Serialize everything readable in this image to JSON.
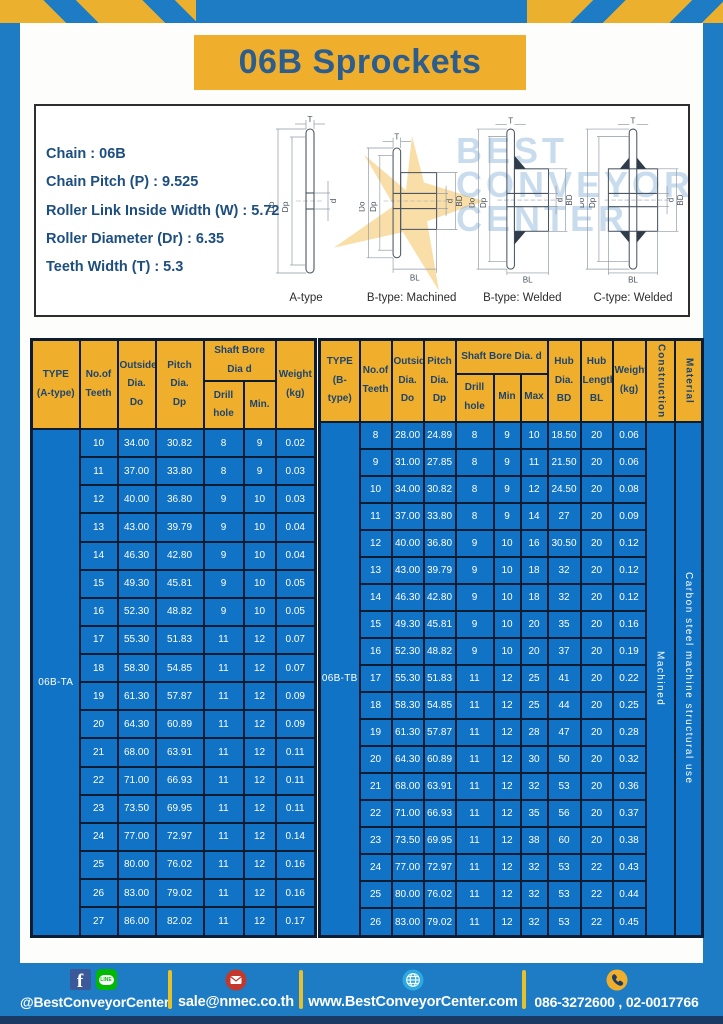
{
  "page": {
    "title": "06B Sprockets"
  },
  "theme": {
    "frame_blue": "#1d7cc4",
    "cell_blue": "#1173c6",
    "accent_yellow": "#efaf2c",
    "header_text_navy": "#1d4470",
    "title_text_blue": "#2d5d8c",
    "table_border": "#0c1c33",
    "bottom_strip_navy": "#1a3a63"
  },
  "specs": {
    "lines": [
      "Chain : 06B",
      "Chain Pitch (P) : 9.525",
      "Roller Link Inside Width (W) : 5.72",
      "Roller Diameter (Dr) : 6.35",
      "Teeth Width (T) : 5.3"
    ]
  },
  "watermark": {
    "lines": [
      "BEST",
      "CONVEYOR",
      "CENTER"
    ]
  },
  "diagrams": [
    {
      "caption": "A-type",
      "dims": {
        "T": "T",
        "Do": "Do",
        "Dp": "Dp",
        "d": "d"
      }
    },
    {
      "caption": "B-type: Machined",
      "dims": {
        "T": "T",
        "Do": "Do",
        "Dp": "Dp",
        "d": "d",
        "BD": "BD",
        "BL": "BL"
      }
    },
    {
      "caption": "B-type: Welded",
      "dims": {
        "T": "T",
        "Do": "Do",
        "Dp": "Dp",
        "d": "d",
        "BD": "BD",
        "BL": "BL"
      }
    },
    {
      "caption": "C-type: Welded",
      "dims": {
        "T": "T",
        "Do": "Do",
        "Dp": "Dp",
        "d": "d",
        "BD": "BD",
        "BL": "BL"
      }
    }
  ],
  "table_a": {
    "type_label": "06B-TA",
    "headers": {
      "type": "TYPE\n(A-type)",
      "teeth": "No.of\nTeeth",
      "outside": "Outside\nDia.\nDo",
      "pitch": "Pitch Dia.\nDp",
      "shaft_group": "Shaft Bore Dia d",
      "drill": "Drill hole",
      "min": "Min.",
      "weight": "Weight\n(kg)"
    },
    "rows": [
      [
        "10",
        "34.00",
        "30.82",
        "8",
        "9",
        "0.02"
      ],
      [
        "11",
        "37.00",
        "33.80",
        "8",
        "9",
        "0.03"
      ],
      [
        "12",
        "40.00",
        "36.80",
        "9",
        "10",
        "0.03"
      ],
      [
        "13",
        "43.00",
        "39.79",
        "9",
        "10",
        "0.04"
      ],
      [
        "14",
        "46.30",
        "42.80",
        "9",
        "10",
        "0.04"
      ],
      [
        "15",
        "49.30",
        "45.81",
        "9",
        "10",
        "0.05"
      ],
      [
        "16",
        "52.30",
        "48.82",
        "9",
        "10",
        "0.05"
      ],
      [
        "17",
        "55.30",
        "51.83",
        "11",
        "12",
        "0.07"
      ],
      [
        "18",
        "58.30",
        "54.85",
        "11",
        "12",
        "0.07"
      ],
      [
        "19",
        "61.30",
        "57.87",
        "11",
        "12",
        "0.09"
      ],
      [
        "20",
        "64.30",
        "60.89",
        "11",
        "12",
        "0.09"
      ],
      [
        "21",
        "68.00",
        "63.91",
        "11",
        "12",
        "0.11"
      ],
      [
        "22",
        "71.00",
        "66.93",
        "11",
        "12",
        "0.11"
      ],
      [
        "23",
        "73.50",
        "69.95",
        "11",
        "12",
        "0.11"
      ],
      [
        "24",
        "77.00",
        "72.97",
        "11",
        "12",
        "0.14"
      ],
      [
        "25",
        "80.00",
        "76.02",
        "11",
        "12",
        "0.16"
      ],
      [
        "26",
        "83.00",
        "79.02",
        "11",
        "12",
        "0.16"
      ],
      [
        "27",
        "86.00",
        "82.02",
        "11",
        "12",
        "0.17"
      ]
    ]
  },
  "table_b": {
    "type_label": "06B-TB",
    "construction": "Machined",
    "material": "Carbon steel machine structural use",
    "headers": {
      "type": "TYPE\n(B-type)",
      "teeth": "No.of\nTeeth",
      "outside": "Outside\nDia.\nDo",
      "pitch": "Pitch\nDia.\nDp",
      "shaft_group": "Shaft Bore Dia. d",
      "drill": "Drill hole",
      "min": "Min",
      "max": "Max",
      "hub_dia": "Hub\nDia.\nBD",
      "hub_len": "Hub\nLength\nBL",
      "weight": "Weight\n(kg)",
      "construction": "Construction",
      "material": "Material"
    },
    "rows": [
      [
        "8",
        "28.00",
        "24.89",
        "8",
        "9",
        "10",
        "18.50",
        "20",
        "0.06"
      ],
      [
        "9",
        "31.00",
        "27.85",
        "8",
        "9",
        "11",
        "21.50",
        "20",
        "0.06"
      ],
      [
        "10",
        "34.00",
        "30.82",
        "8",
        "9",
        "12",
        "24.50",
        "20",
        "0.08"
      ],
      [
        "11",
        "37.00",
        "33.80",
        "8",
        "9",
        "14",
        "27",
        "20",
        "0.09"
      ],
      [
        "12",
        "40.00",
        "36.80",
        "9",
        "10",
        "16",
        "30.50",
        "20",
        "0.12"
      ],
      [
        "13",
        "43.00",
        "39.79",
        "9",
        "10",
        "18",
        "32",
        "20",
        "0.12"
      ],
      [
        "14",
        "46.30",
        "42.80",
        "9",
        "10",
        "18",
        "32",
        "20",
        "0.12"
      ],
      [
        "15",
        "49.30",
        "45.81",
        "9",
        "10",
        "20",
        "35",
        "20",
        "0.16"
      ],
      [
        "16",
        "52.30",
        "48.82",
        "9",
        "10",
        "20",
        "37",
        "20",
        "0.19"
      ],
      [
        "17",
        "55.30",
        "51.83",
        "11",
        "12",
        "25",
        "41",
        "20",
        "0.22"
      ],
      [
        "18",
        "58.30",
        "54.85",
        "11",
        "12",
        "25",
        "44",
        "20",
        "0.25"
      ],
      [
        "19",
        "61.30",
        "57.87",
        "11",
        "12",
        "28",
        "47",
        "20",
        "0.28"
      ],
      [
        "20",
        "64.30",
        "60.89",
        "11",
        "12",
        "30",
        "50",
        "20",
        "0.32"
      ],
      [
        "21",
        "68.00",
        "63.91",
        "11",
        "12",
        "32",
        "53",
        "20",
        "0.36"
      ],
      [
        "22",
        "71.00",
        "66.93",
        "11",
        "12",
        "35",
        "56",
        "20",
        "0.37"
      ],
      [
        "23",
        "73.50",
        "69.95",
        "11",
        "12",
        "38",
        "60",
        "20",
        "0.38"
      ],
      [
        "24",
        "77.00",
        "72.97",
        "11",
        "12",
        "32",
        "53",
        "22",
        "0.43"
      ],
      [
        "25",
        "80.00",
        "76.02",
        "11",
        "12",
        "32",
        "53",
        "22",
        "0.44"
      ],
      [
        "26",
        "83.00",
        "79.02",
        "11",
        "12",
        "32",
        "53",
        "22",
        "0.45"
      ]
    ]
  },
  "footer": {
    "facebook_letter": "f",
    "line_label": "LINE",
    "social": "@BestConveyorCenter",
    "email": "sale@nmec.co.th",
    "website": "www.BestConveyorCenter.com",
    "phone": "086-3272600 , 02-0017766"
  }
}
